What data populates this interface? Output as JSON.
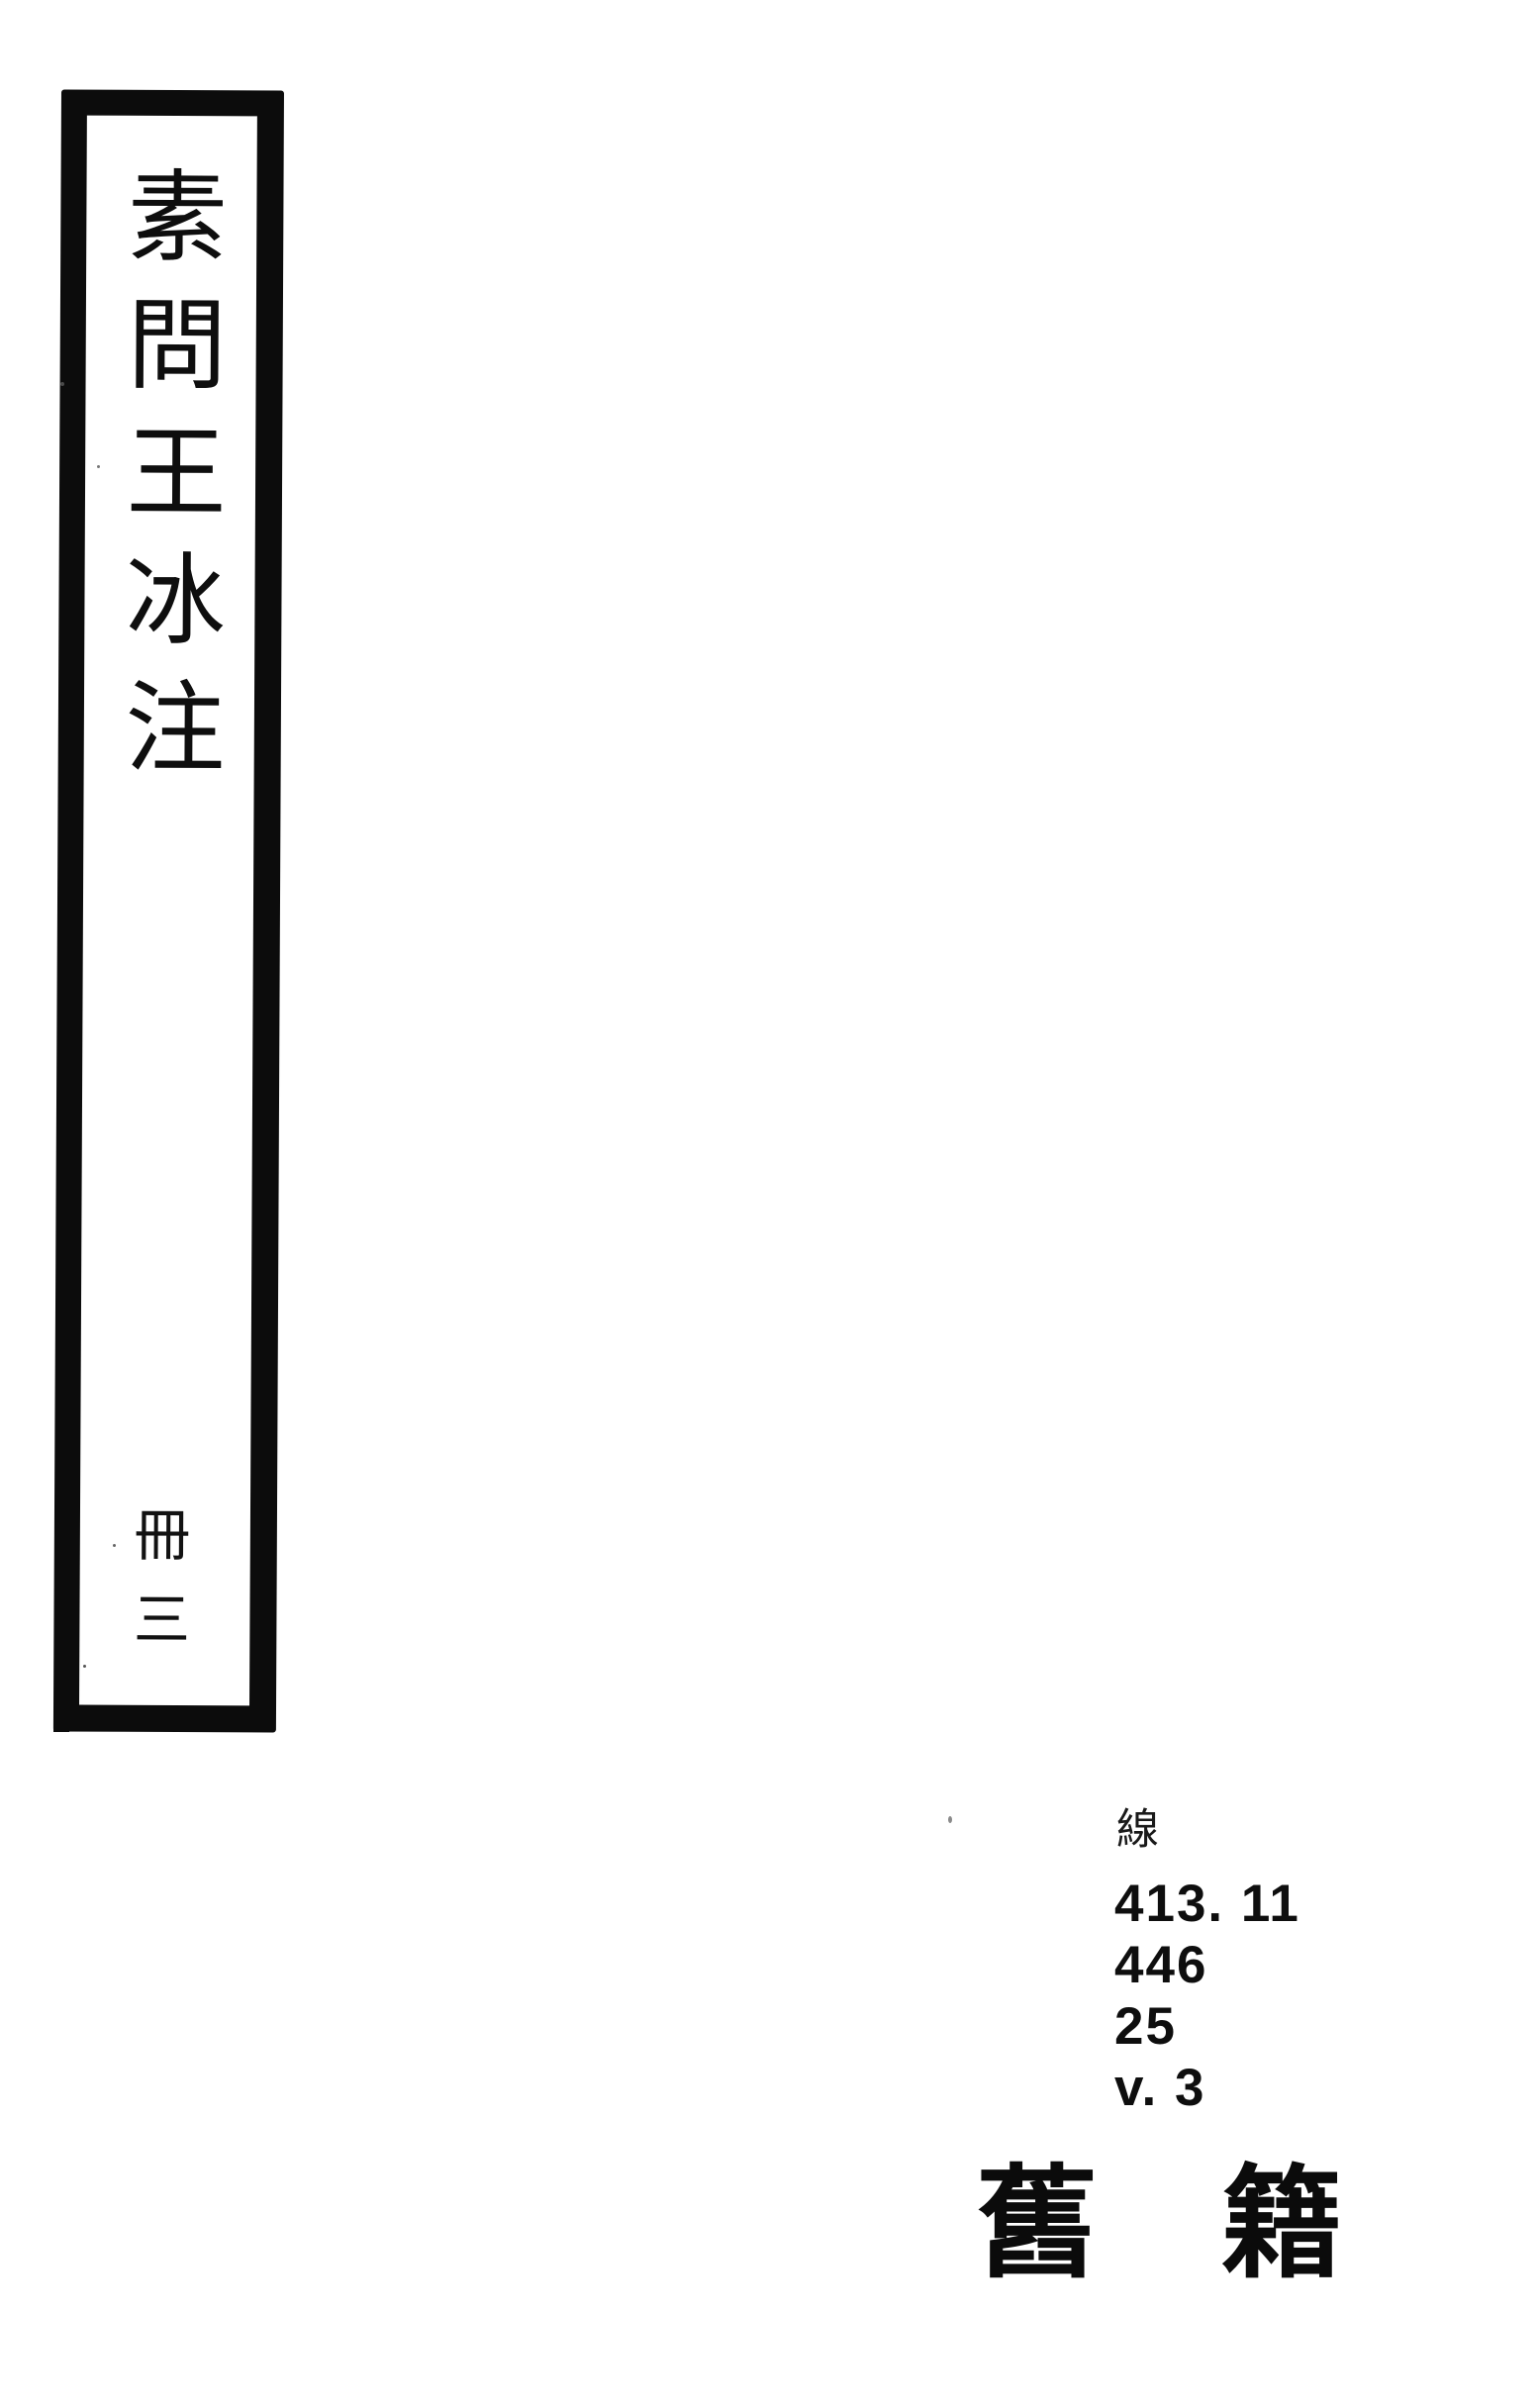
{
  "document": {
    "paper_color": "#ffffff",
    "ink_color": "#0c0c0c"
  },
  "spine": {
    "title": "素問王冰注",
    "volume_label": "冊三"
  },
  "call_number": {
    "collection_prefix": "線",
    "lines": [
      "413. 11",
      "446",
      "25",
      "v. 3"
    ]
  },
  "stamp": {
    "text": "舊籍"
  }
}
